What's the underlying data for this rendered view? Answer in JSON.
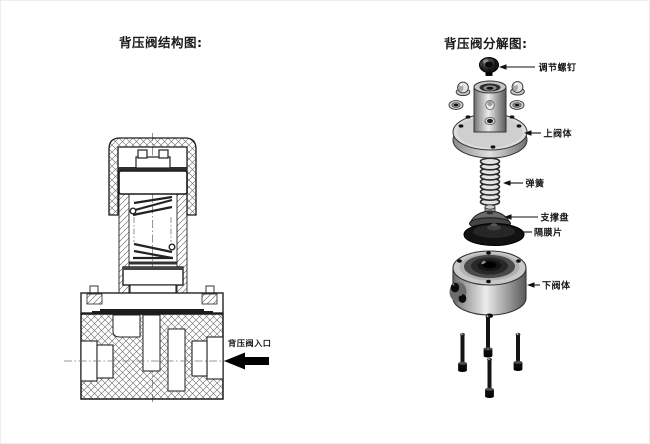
{
  "titles": {
    "structure": "背压阀结构图:",
    "exploded": "背压阀分解图:"
  },
  "structure_diagram": {
    "name": "back-pressure valve cross-section",
    "inlet_label": "背压阀入口"
  },
  "exploded_diagram": {
    "name": "back-pressure valve exploded view",
    "parts": [
      {
        "id": "adjust-screw",
        "label": "调节螺钉"
      },
      {
        "id": "upper-valve-body",
        "label": "上阀体"
      },
      {
        "id": "spring",
        "label": "弹簧"
      },
      {
        "id": "support-disc",
        "label": "支撑盘"
      },
      {
        "id": "diaphragm",
        "label": "隔膜片"
      },
      {
        "id": "lower-valve-body",
        "label": "下阀体"
      }
    ]
  },
  "colors": {
    "line": "#1a1a1a",
    "dark_part": "#111111",
    "mid_gray": "#9a9a9a",
    "light_gray": "#e8e8e8",
    "background": "#ffffff"
  }
}
